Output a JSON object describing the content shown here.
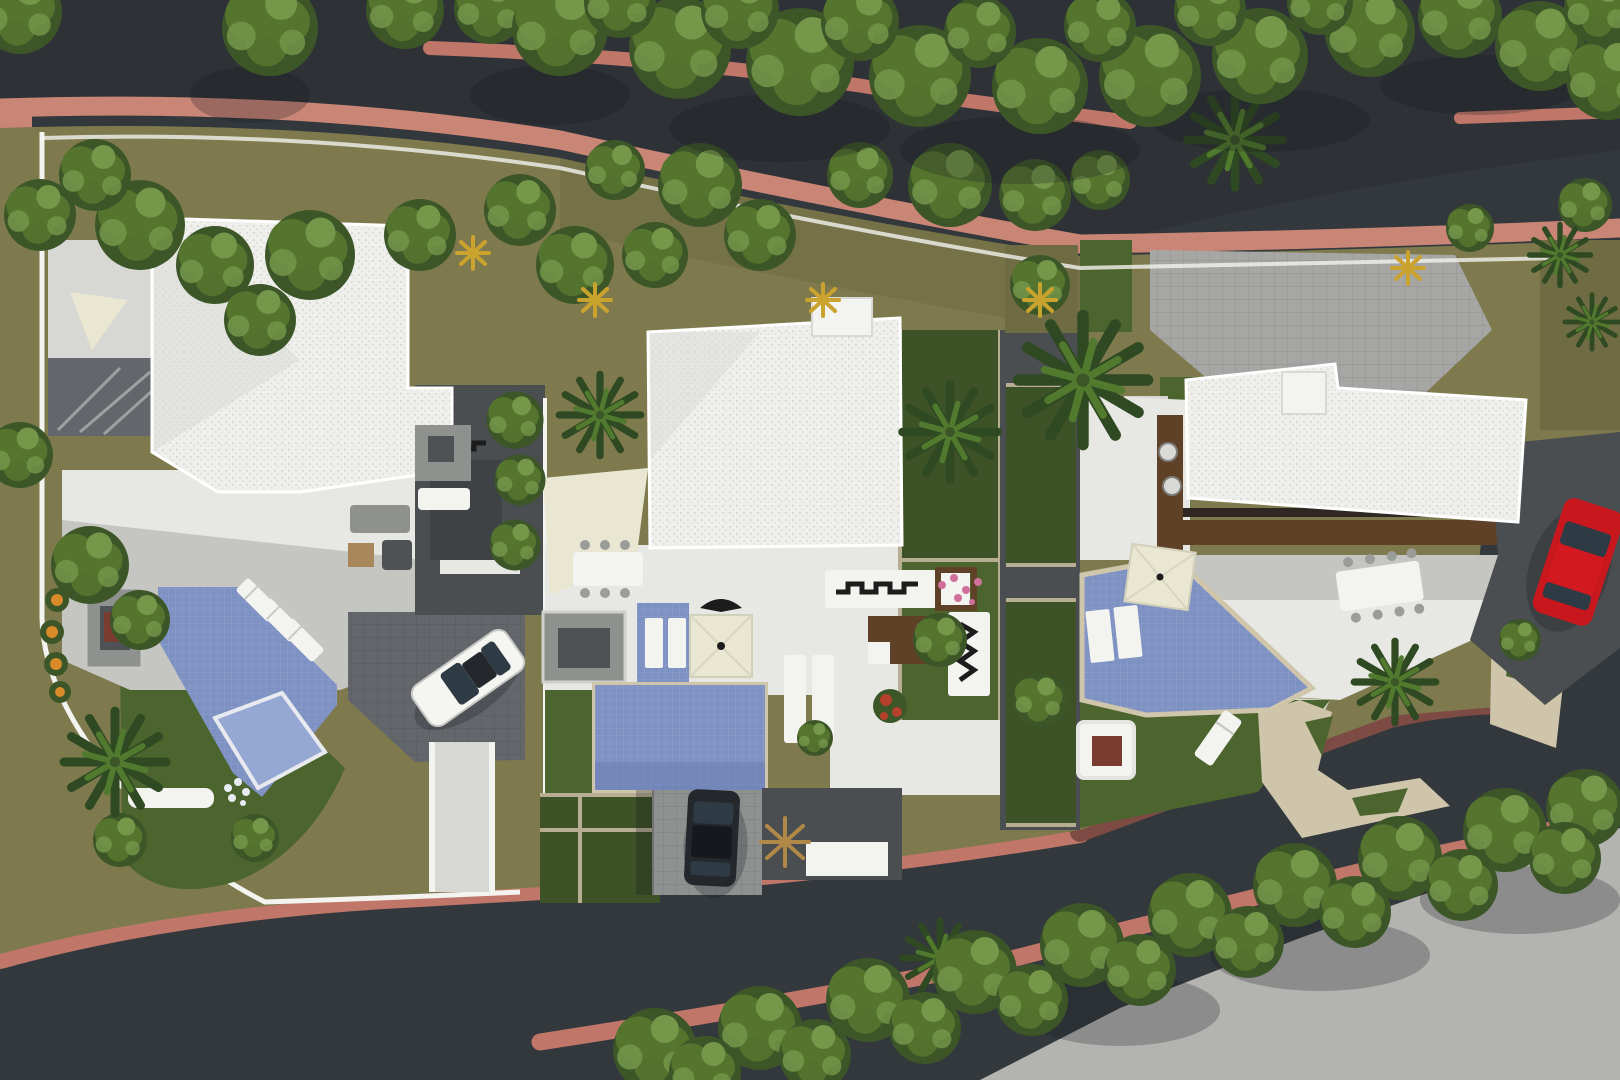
{
  "scene": {
    "type": "aerial-site-plan-render",
    "villas_count": 3,
    "pools_count": 3,
    "vehicles": [
      {
        "name": "white-car",
        "color_key": "car_white"
      },
      {
        "name": "dark-car",
        "color_key": "car_dark"
      },
      {
        "name": "red-car",
        "color_key": "car_red"
      }
    ]
  },
  "colors": {
    "asphalt": "#33383c",
    "asphalt_dark": "#2a2e32",
    "concrete_light": "#b3b3b0",
    "sidewalk_salmon": "#c0776a",
    "sidewalk_salmon_light": "#c98576",
    "sidewalk_maroon": "#7e4a44",
    "site_olive": "#7e7a4e",
    "site_olive_dark": "#6f6c44",
    "lawn": "#4c652f",
    "lawn_dark": "#3d5226",
    "wall_white": "#f3f3f0",
    "stone": "#b7ad93",
    "roof_white": "#efefec",
    "roof_shade": "#d9d9d5",
    "terrace": "#e7e7e3",
    "terrace_dim": "#d7d7d3",
    "paver_light": "#a6a7a4",
    "paver_mid": "#8f9190",
    "drive_dark": "#63666a",
    "court_dark": "#4b4e51",
    "pit_dark": "#3f4245",
    "pool_blue": "#7e91c3",
    "pool_light": "#95a7d3",
    "pool_deep": "#657aae",
    "coping": "#cfc5aa",
    "cream": "#e9e7d2",
    "wood": "#5f4128",
    "wood_dark": "#2e2722",
    "tree_base": "#3c5628",
    "tree_light": "#55752f",
    "tree_hi": "#74974a",
    "palm_dark": "#2f4a22",
    "palm_light": "#527a2e",
    "furn_gray": "#8f918e",
    "furn_dark": "#4e5254",
    "table_wood": "#a8885a",
    "grill": "#7a3b30",
    "flower_orange": "#d98a2b",
    "flower_pink": "#cf6f9c",
    "flower_red": "#b5412c",
    "dry_palm": "#b08948",
    "car_white": "#f5f5f2",
    "car_red": "#c8181e",
    "car_dark": "#24272c",
    "glass": "#2e3b44",
    "ink": "#1c1c1c",
    "shadow": "rgba(18,22,26,0.25)",
    "shadow_soft": "rgba(18,22,26,0.16)"
  }
}
